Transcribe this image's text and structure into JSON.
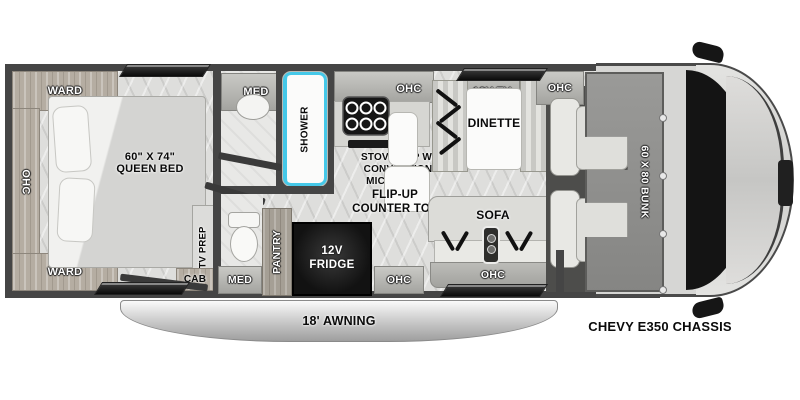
{
  "floorplan": {
    "chassis_label": "CHEVY E350 CHASSIS",
    "awning_label": "18' AWNING",
    "bunk_label": "60 X 80 BUNK",
    "bedroom": {
      "ward_top": "WARD",
      "ward_bottom": "WARD",
      "ohc": "OHC",
      "bed_size": "60\" X 74\"",
      "bed_name": "QUEEN BED",
      "tv_prep": "TV PREP",
      "cab": "CAB"
    },
    "bathroom": {
      "med_top": "MED",
      "shower": "SHOWER",
      "med_bottom": "MED"
    },
    "kitchen": {
      "ohc": "OHC",
      "stove": "STOVE TOP W/\nCONVECTION\nMICROWAVE",
      "flip_up": "FLIP-UP\nCOUNTER TOP",
      "pantry": "PANTRY",
      "fridge": "12V\nFRIDGE",
      "ohc_lower": "OHC"
    },
    "dinette": {
      "tv": "12V TV",
      "label": "DINETTE",
      "ohc": "OHC"
    },
    "sofa": {
      "label": "SOFA",
      "ohc": "OHC"
    }
  },
  "colors": {
    "wall": "#454545",
    "accent_blue": "#45c8e8",
    "fridge_black": "#141414",
    "bunk_gray": "#8e8e8e",
    "awning_silver": "#c9c9c9"
  }
}
